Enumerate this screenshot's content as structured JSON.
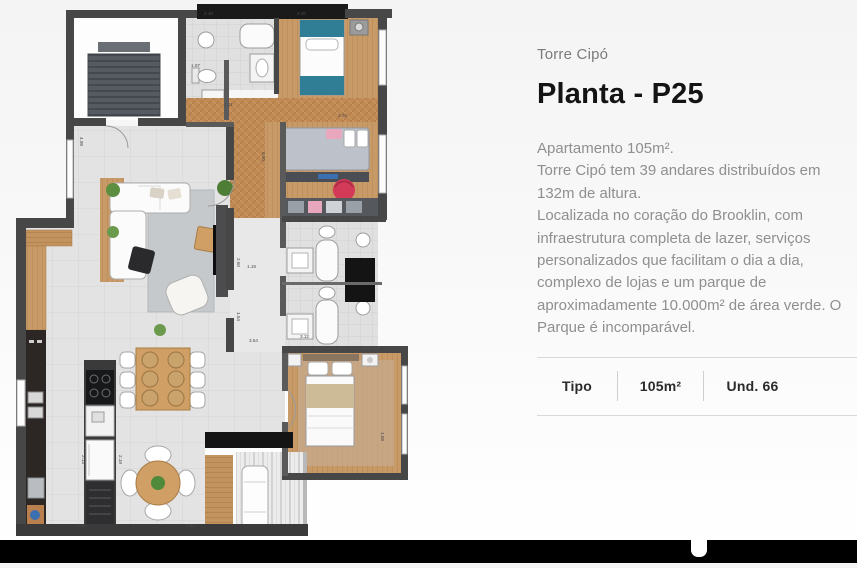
{
  "content": {
    "overline": "Torre Cipó",
    "title": "Planta - P25",
    "description_paragraphs": [
      "Apartamento 105m².",
      "Torre Cipó tem 39 andares distribuídos em 132m de altura.",
      "Localizada no coração do Brooklin, com infraestrutura completa de lazer, serviços personalizados que facilitam o dia a dia, complexo de lojas e um parque de aproximadamente 10.000m² de área verde. O Parque é incomparável."
    ],
    "specs_table": {
      "type_label": "Tipo",
      "area_value": "105m²",
      "units_value": "Und. 66"
    }
  },
  "floor_plan": {
    "dimension_labels": [
      {
        "text": "2.10",
        "x": 204,
        "y": 15,
        "rotate": 0
      },
      {
        "text": "2.40",
        "x": 297,
        "y": 15,
        "rotate": 0
      },
      {
        "text": "1.07",
        "x": 191,
        "y": 67,
        "rotate": 0
      },
      {
        "text": "1.21",
        "x": 224,
        "y": 106,
        "rotate": 0
      },
      {
        "text": "3.78",
        "x": 338,
        "y": 117,
        "rotate": 0
      },
      {
        "text": "0.90",
        "x": 262,
        "y": 152,
        "rotate": 90
      },
      {
        "text": "4.98",
        "x": 80,
        "y": 137,
        "rotate": 90
      },
      {
        "text": "2.60",
        "x": 237,
        "y": 258,
        "rotate": 90
      },
      {
        "text": "1.54",
        "x": 237,
        "y": 312,
        "rotate": 90
      },
      {
        "text": "1.19",
        "x": 247,
        "y": 268,
        "rotate": 0
      },
      {
        "text": "3.54",
        "x": 249,
        "y": 342,
        "rotate": 0
      },
      {
        "text": "3.12",
        "x": 300,
        "y": 338,
        "rotate": 0
      },
      {
        "text": "1.58",
        "x": 381,
        "y": 432,
        "rotate": 90
      },
      {
        "text": "2.13",
        "x": 82,
        "y": 455,
        "rotate": 90
      },
      {
        "text": "2.19",
        "x": 119,
        "y": 455,
        "rotate": 90
      },
      {
        "text": "1.40",
        "x": 77,
        "y": 527,
        "rotate": 0
      },
      {
        "text": "2.91",
        "x": 186,
        "y": 527,
        "rotate": 0
      }
    ],
    "colors": {
      "wall": "#474747",
      "wall_dark": "#1a1a1a",
      "wood_floor": "#c79a68",
      "herringbone_wood": "#c08a55",
      "tile": "#e4e4e4",
      "teal_bed": "#2f7e95",
      "red_pouf": "#d23a58",
      "gray_duvet": "#bdc1c9",
      "beige_blanket": "#cdbb98",
      "counter_dark": "#2c2724",
      "plant_green": "#5d8f41"
    }
  }
}
